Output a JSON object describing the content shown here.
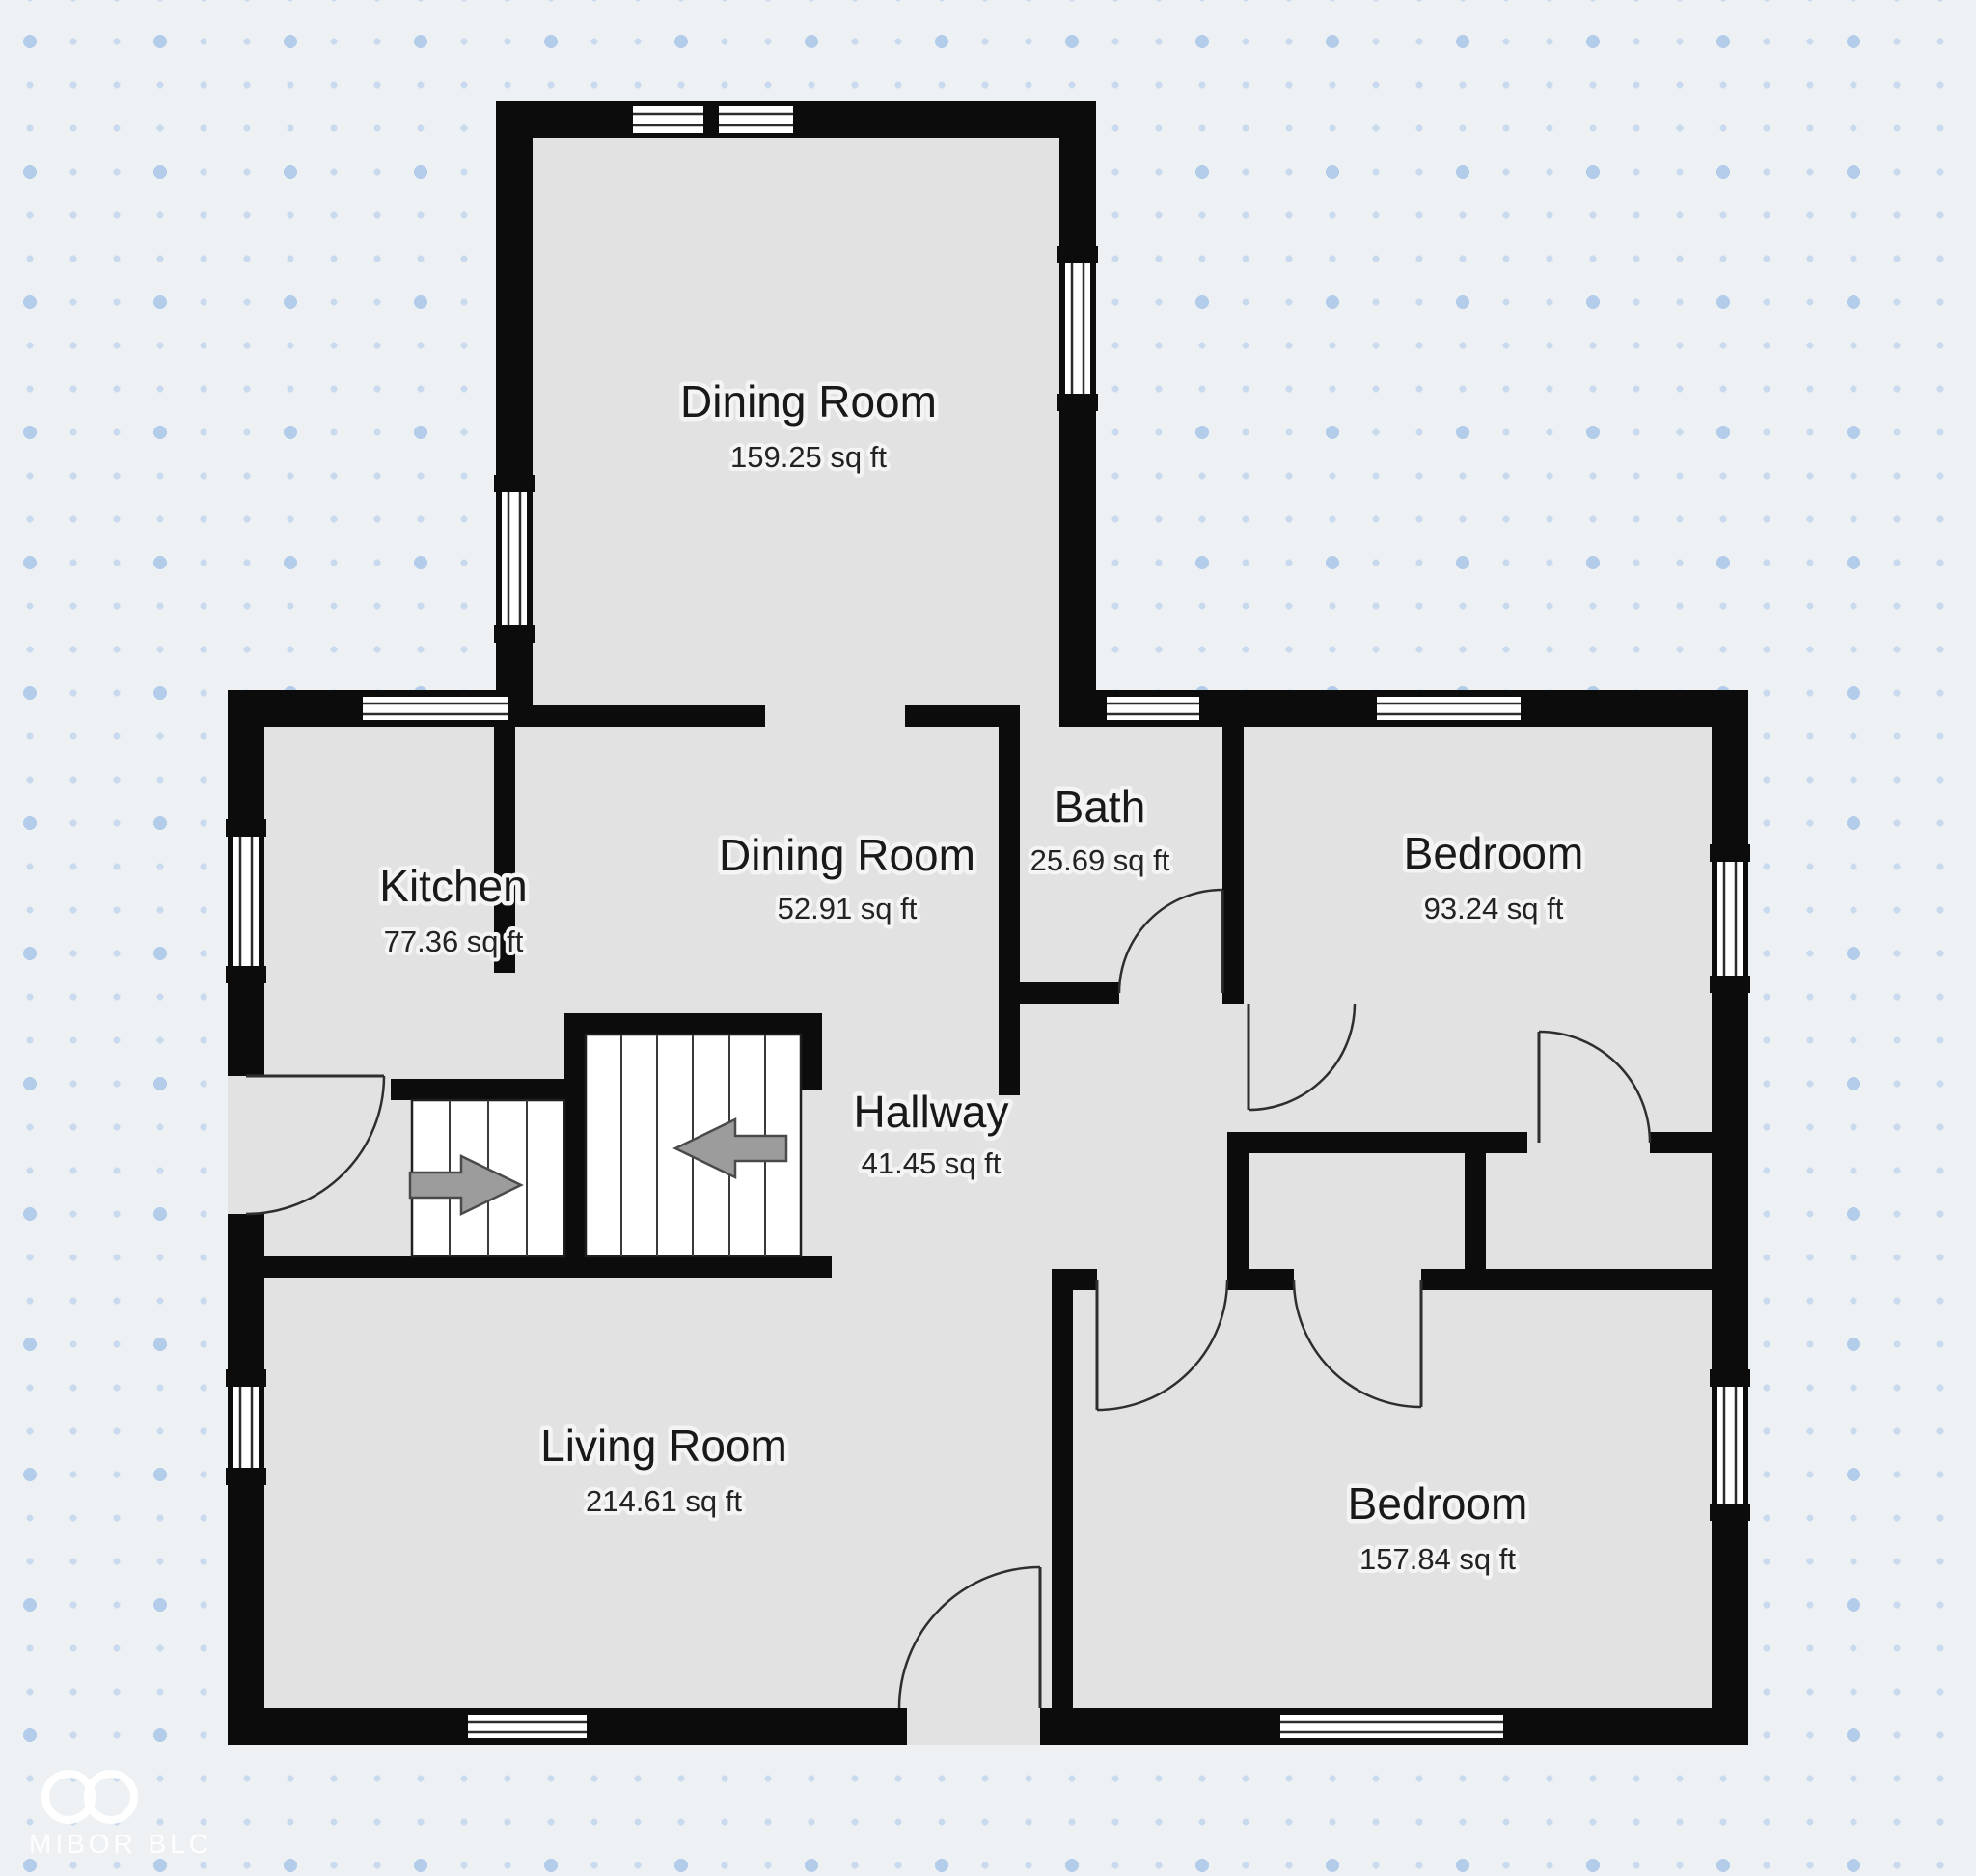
{
  "rooms": [
    {
      "id": "dining-room-top",
      "name": "Dining Room",
      "area": "159.25 sq ft"
    },
    {
      "id": "kitchen",
      "name": "Kitchen",
      "area": "77.36 sq ft"
    },
    {
      "id": "dining-room-middle",
      "name": "Dining Room",
      "area": "52.91 sq ft"
    },
    {
      "id": "bath",
      "name": "Bath",
      "area": "25.69 sq ft"
    },
    {
      "id": "bedroom-upper",
      "name": "Bedroom",
      "area": "93.24 sq ft"
    },
    {
      "id": "hallway",
      "name": "Hallway",
      "area": "41.45 sq ft"
    },
    {
      "id": "living-room",
      "name": "Living Room",
      "area": "214.61 sq ft"
    },
    {
      "id": "bedroom-lower",
      "name": "Bedroom",
      "area": "157.84 sq ft"
    }
  ],
  "watermark": {
    "brand": "MIBOR BLC",
    "logo": "infinity-icon"
  },
  "colors": {
    "background": "#eef1f4",
    "dot_small": "#c9daee",
    "dot_large": "#b3cce9",
    "room_fill": "#e2e2e2",
    "wall": "#0c0c0c",
    "window_glass": "#ffffff",
    "stair_arrow": "#9c9c9c",
    "watermark": "#ffffff"
  }
}
